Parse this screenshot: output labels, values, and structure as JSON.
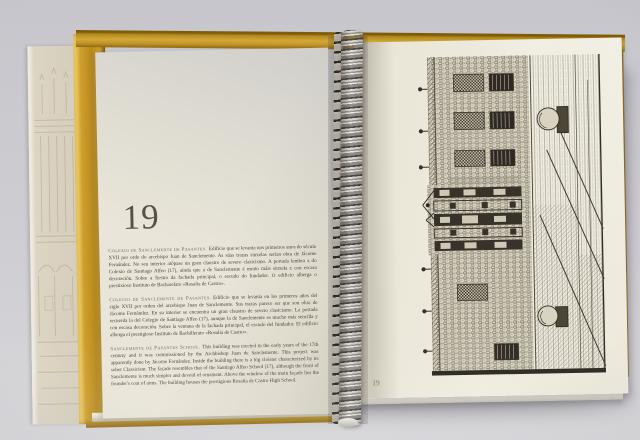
{
  "book": {
    "left_page": {
      "chapter_number": "19",
      "paragraphs": [
        {
          "language": "galician",
          "header": "Colexio de Sanclemente de Pasantes.",
          "body": "Edificio que se levanta nos primeiros anos do século XVII por orde do arcebispo Juan de Sanclemente. As súas trazas sinxelas serían obra de Jácome Fernández. No seu interior atópase un gran claustro de severo clasicismo. A portada lembra a do Colexio de Santiago Alfeo (17), aínda que a de Sanclemente é moito máis sinxela e con escasa decoración. Sobre a fiestra da fachada principal, o escudo do fundador. O edificio alberga o prestixioso Instituto de Bacharelato «Rosalía de Castro»."
        },
        {
          "language": "spanish",
          "header": "Colegio de Sanclemente de Pasantes.",
          "body": "Edificio que se levanta en los primeros años del siglo XVII por orden del arzobispo Juan de Sanclemente. Sus trazas parece ser que son obra de Jácome Fernández. En su interior se encuentra un gran claustro de severo clasicismo. La portada recuerda la del Colegio de Santiago Alfeo (17), aunque la de Sanclemente es mucho más sencilla y con escasa decoración. Sobre la ventana de la fachada principal, el escudo del fundador. El edificio alberga el prestigioso Instituto de Bachillerato «Rosalía de Castro»."
        },
        {
          "language": "english",
          "header": "Sanclemente de Pasantes School.",
          "body": "This building was erected in the early years of the 17th century and it was commissioned by the Archbishop Juan de Sanclemente. This project was apparently done by Jácome Fernández. Inside the building there is a big cloister characterized by its sober Classicism. The façade resembles that of the Santiago Alfeo School (17), although the front of Sanclemente is much simpler and devoid of ornament. Above the window of the main façade lies the founder's coat of arms. The building houses the prestigious Rosalía de Castro High School."
        }
      ]
    },
    "right_page": {
      "page_number": "19",
      "illustration_alt": "Pen-and-ink engraving of the Sanclemente college façade and cobbled square, printed rotated 90 degrees on the page"
    },
    "colors": {
      "cover_gold": "#c9992a",
      "page_cream": "#e9e5d7",
      "ink": "#3f3a32",
      "background_gray": "#cfced3",
      "spiral_metal": "#c9c6c0"
    }
  }
}
